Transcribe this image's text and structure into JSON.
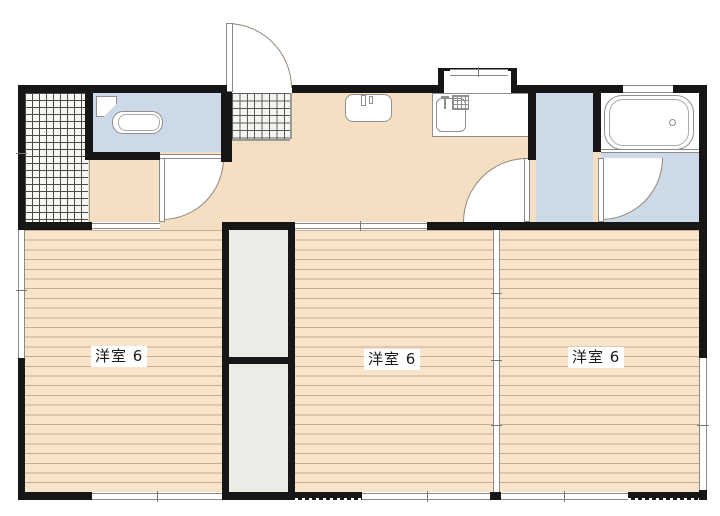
{
  "floorplan": {
    "rooms": [
      {
        "label": "洋室 6"
      },
      {
        "label": "洋室 6"
      },
      {
        "label": "洋室 6"
      }
    ],
    "colors": {
      "wall": "#161616",
      "wood_floor": "#f8e3cb",
      "wood_stripe": "#c9ac8f",
      "hall_floor": "#f5dfc3",
      "wet_area_blue": "#ccd9e6",
      "closet_ivory": "#ecece6",
      "tile_bg": "#f8f8f3",
      "line_gray": "#8a8a8a"
    }
  }
}
